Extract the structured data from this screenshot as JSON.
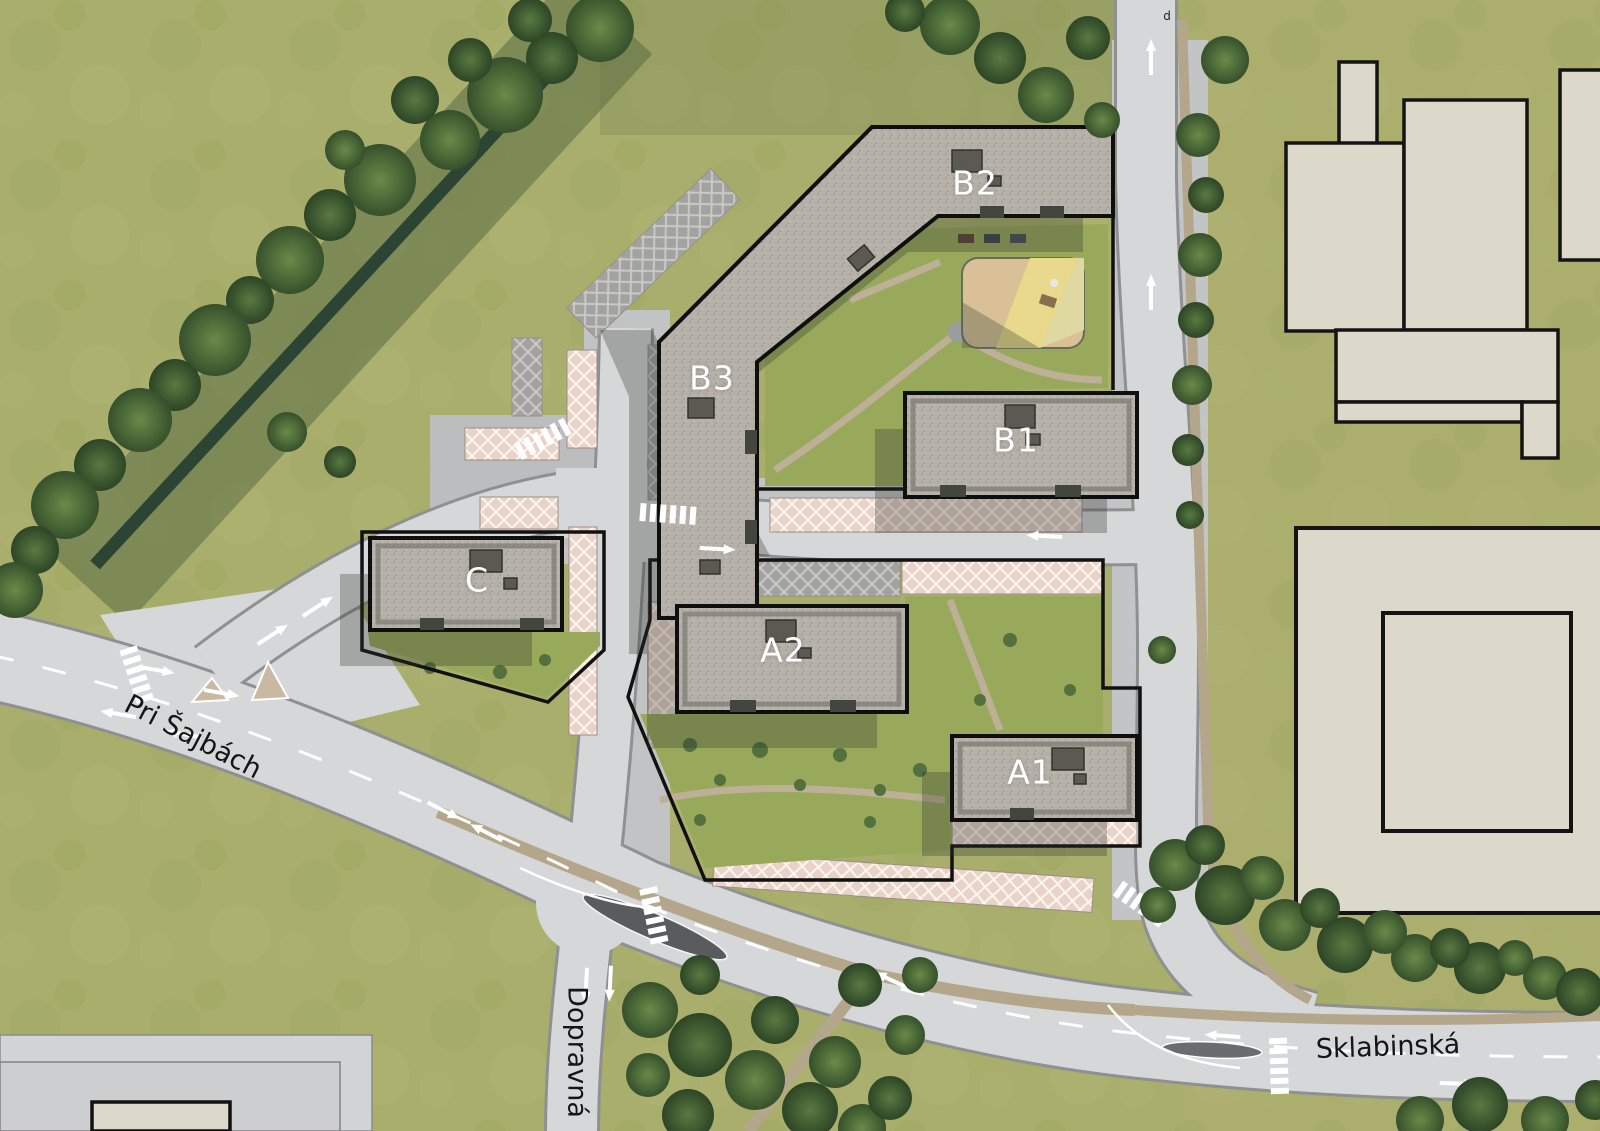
{
  "map": {
    "building_labels": [
      {
        "id": "B2",
        "label": "B2"
      },
      {
        "id": "B3",
        "label": "B3"
      },
      {
        "id": "B1",
        "label": "B1"
      },
      {
        "id": "C",
        "label": "C"
      },
      {
        "id": "A2",
        "label": "A2"
      },
      {
        "id": "A1",
        "label": "A1"
      }
    ],
    "street_labels": [
      {
        "id": "pri-sajbach",
        "label": "Pri Šajbách"
      },
      {
        "id": "dopravna",
        "label": "Dopravná"
      },
      {
        "id": "sklabinska",
        "label": "Sklabinská"
      }
    ],
    "annotations": [
      {
        "id": "d",
        "label": "d"
      }
    ],
    "colors": {
      "grass": "#a9ae6c",
      "road": "#d6d7d8",
      "roof_gravel": "#b5b1a8",
      "building_outline": "#111111",
      "existing_building": "#dcd9cb",
      "parking_hatch_pink": "#e9d3c8",
      "parking_hatch_gray": "#a2a3a1",
      "tree_green": "#4d6b38",
      "courtyard_green": "#98a95c",
      "playground_sand": "#d9c097",
      "playground_yellow": "#e8d98c",
      "creek": "#2c4434",
      "building_label": "#ffffff",
      "street_label": "#151515"
    }
  }
}
